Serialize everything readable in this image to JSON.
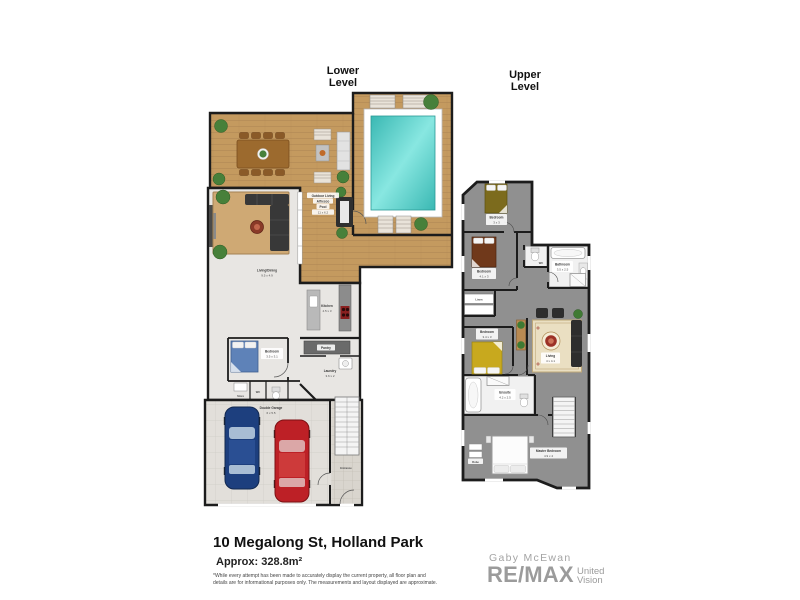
{
  "titles": {
    "lower": "Lower Level",
    "upper": "Upper Level"
  },
  "lower": {
    "outdoor": {
      "line1": "Outdoor Living",
      "line2": "Alfresco",
      "line3": "Pool",
      "dims": "11 x 6.2"
    },
    "living_dining": {
      "name": "Living/Dining",
      "dims": "9.5 x 4.9"
    },
    "kitchen": {
      "name": "Kitchen",
      "dims": "4.5 x 3"
    },
    "pantry": {
      "name": "Pantry"
    },
    "laundry": {
      "name": "Laundry",
      "dims": "3.6 x 2"
    },
    "bedroom": {
      "name": "Bedroom",
      "dims": "3.5 x 3.1"
    },
    "store": {
      "name": "Store"
    },
    "wc": {
      "name": "WC"
    },
    "garage": {
      "name": "Double Garage",
      "dims": "6 x 5.5"
    },
    "entrance": {
      "name": "Entrance"
    }
  },
  "upper": {
    "bedroom1": {
      "name": "Bedroom",
      "dims": "3 x 3"
    },
    "bedroom2": {
      "name": "Bedroom",
      "dims": "4.1 x 3"
    },
    "wc": {
      "name": "WC"
    },
    "bathroom": {
      "name": "Bathroom",
      "dims": "3.5 x 2.5"
    },
    "linen": {
      "name": "Linen"
    },
    "bedroom3": {
      "name": "Bedroom",
      "dims": "3.4 x 3"
    },
    "living": {
      "name": "Living",
      "dims": "4 x 4.1"
    },
    "ensuite": {
      "name": "Ensuite",
      "dims": "4.2 x 2.5"
    },
    "master": {
      "name": "Master Bedroom",
      "dims": "4.9 x 4"
    },
    "robe": {
      "name": "Robe"
    }
  },
  "footer": {
    "address": "10 Megalong St, Holland Park",
    "area": "Approx: 328.8m²",
    "disclaimer_line1": "*While every attempt has been made to accurately display the current property, all floor plan and",
    "disclaimer_line2": "details are for informational purposes only. The measurements and layout displayed are approximate."
  },
  "branding": {
    "agent": "Gaby McEwan",
    "brand": "RE/MAX",
    "suffix_line1": "United",
    "suffix_line2": "Vision"
  },
  "colors": {
    "deck_wood": "#c49a5f",
    "pool_water": "#4fc9c4",
    "walls": "#1c1c1c",
    "lower_floor": "#e8e6e3",
    "upper_floor": "#909090",
    "garage_floor": "#e2dfda",
    "car_blue": "#1d3f7e",
    "car_red": "#bd2026",
    "bed_blue": "#5e82b8",
    "bed_olive": "#7c6b1d",
    "bed_brown": "#70391b",
    "bed_yellow": "#c8a91e",
    "brand_gray": "#9b9b9b"
  }
}
